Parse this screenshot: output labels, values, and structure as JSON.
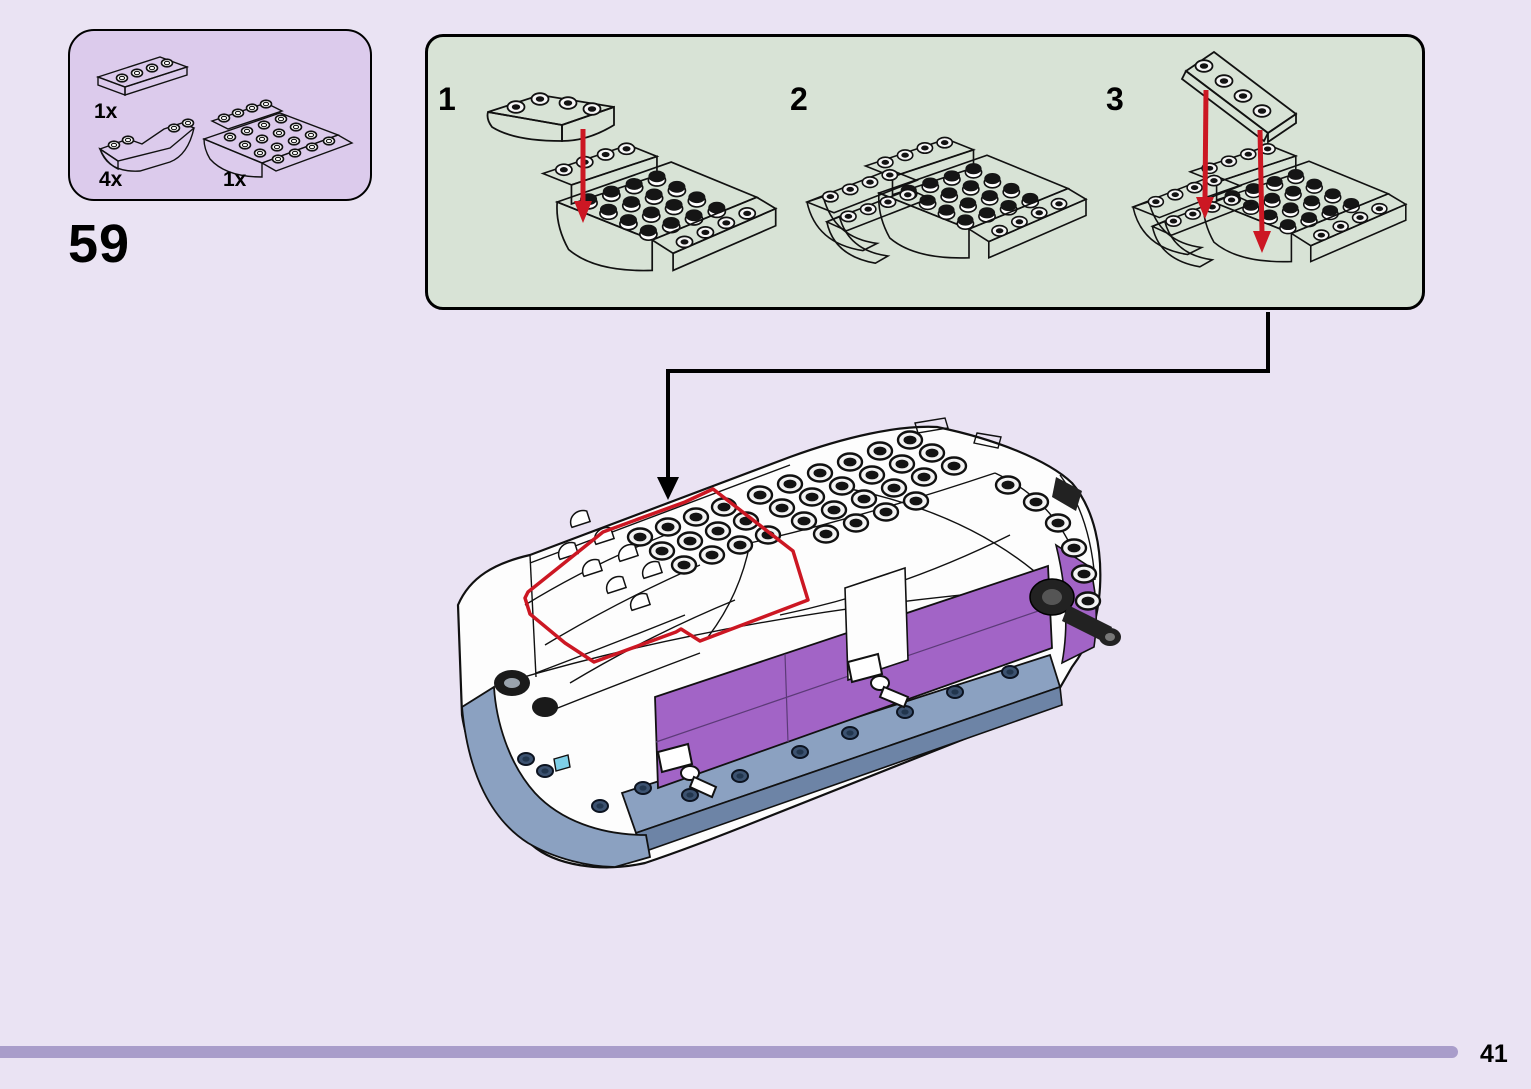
{
  "page": {
    "step_number": "59",
    "page_number": "41"
  },
  "parts_box": {
    "parts": [
      {
        "count": "1x",
        "part": "plate-1x4-white"
      },
      {
        "count": "4x",
        "part": "inverted-curved-slope-white"
      },
      {
        "count": "1x",
        "part": "inverted-double-slope-4x6-white"
      }
    ]
  },
  "substeps": {
    "steps": [
      {
        "number": "1"
      },
      {
        "number": "2"
      },
      {
        "number": "3"
      }
    ]
  },
  "colors": {
    "background": "#eae3f3",
    "parts_box_fill": "#dccbec",
    "substeps_fill": "#d8e3d6",
    "ink": "#000000",
    "guide_red": "#cc1723",
    "lego_purple": "#a264c6",
    "lego_purple_dark": "#8a4fae",
    "lego_sand_blue": "#8ba1c1",
    "lego_sand_blue_dark": "#6d84a6",
    "stud_navy": "#3c5270",
    "lego_azure": "#7fd0e8",
    "footer_bar": "#a99dca",
    "lego_white": "#ffffff"
  }
}
